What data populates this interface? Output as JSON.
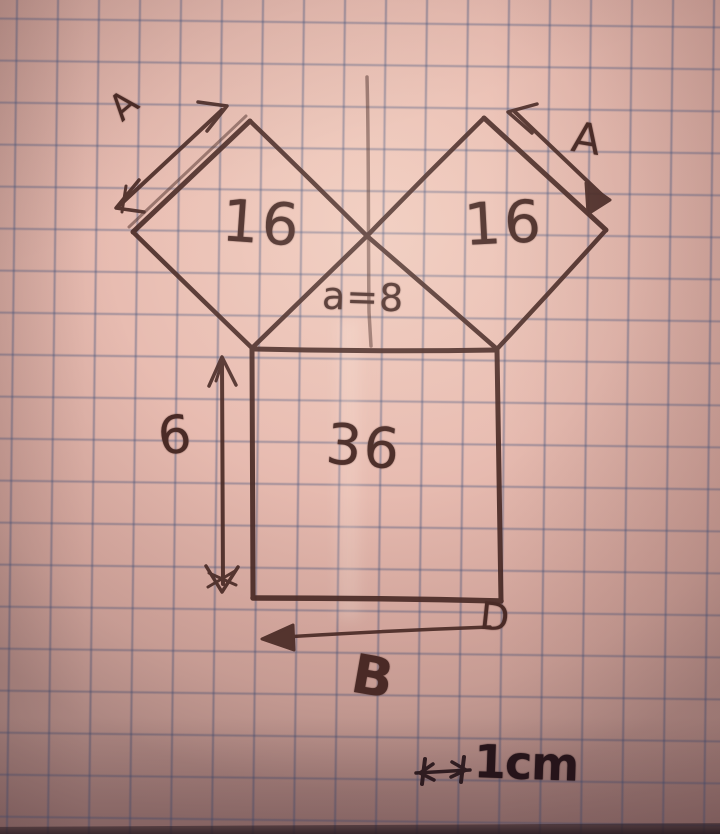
{
  "figure": {
    "description": "hand-drawn geometry diagram on squared paper: two tilted squares on top of a larger square (Pythagoras-style)",
    "left_tilted_square": {
      "area_label": "16",
      "side_arrow_label": "A"
    },
    "right_tilted_square": {
      "area_label": "16",
      "side_arrow_label": "A"
    },
    "middle_note": "a=8",
    "bottom_square": {
      "area_label": "36",
      "left_side_label": "6",
      "base_label": "B",
      "bottom_right_corner_label": "D"
    },
    "scale": {
      "label": "1cm"
    }
  },
  "colors": {
    "paper": "#e8bcb1",
    "grid_line": "#5f6f94",
    "ink": "#4a2b26",
    "ink_dark": "#241419"
  }
}
